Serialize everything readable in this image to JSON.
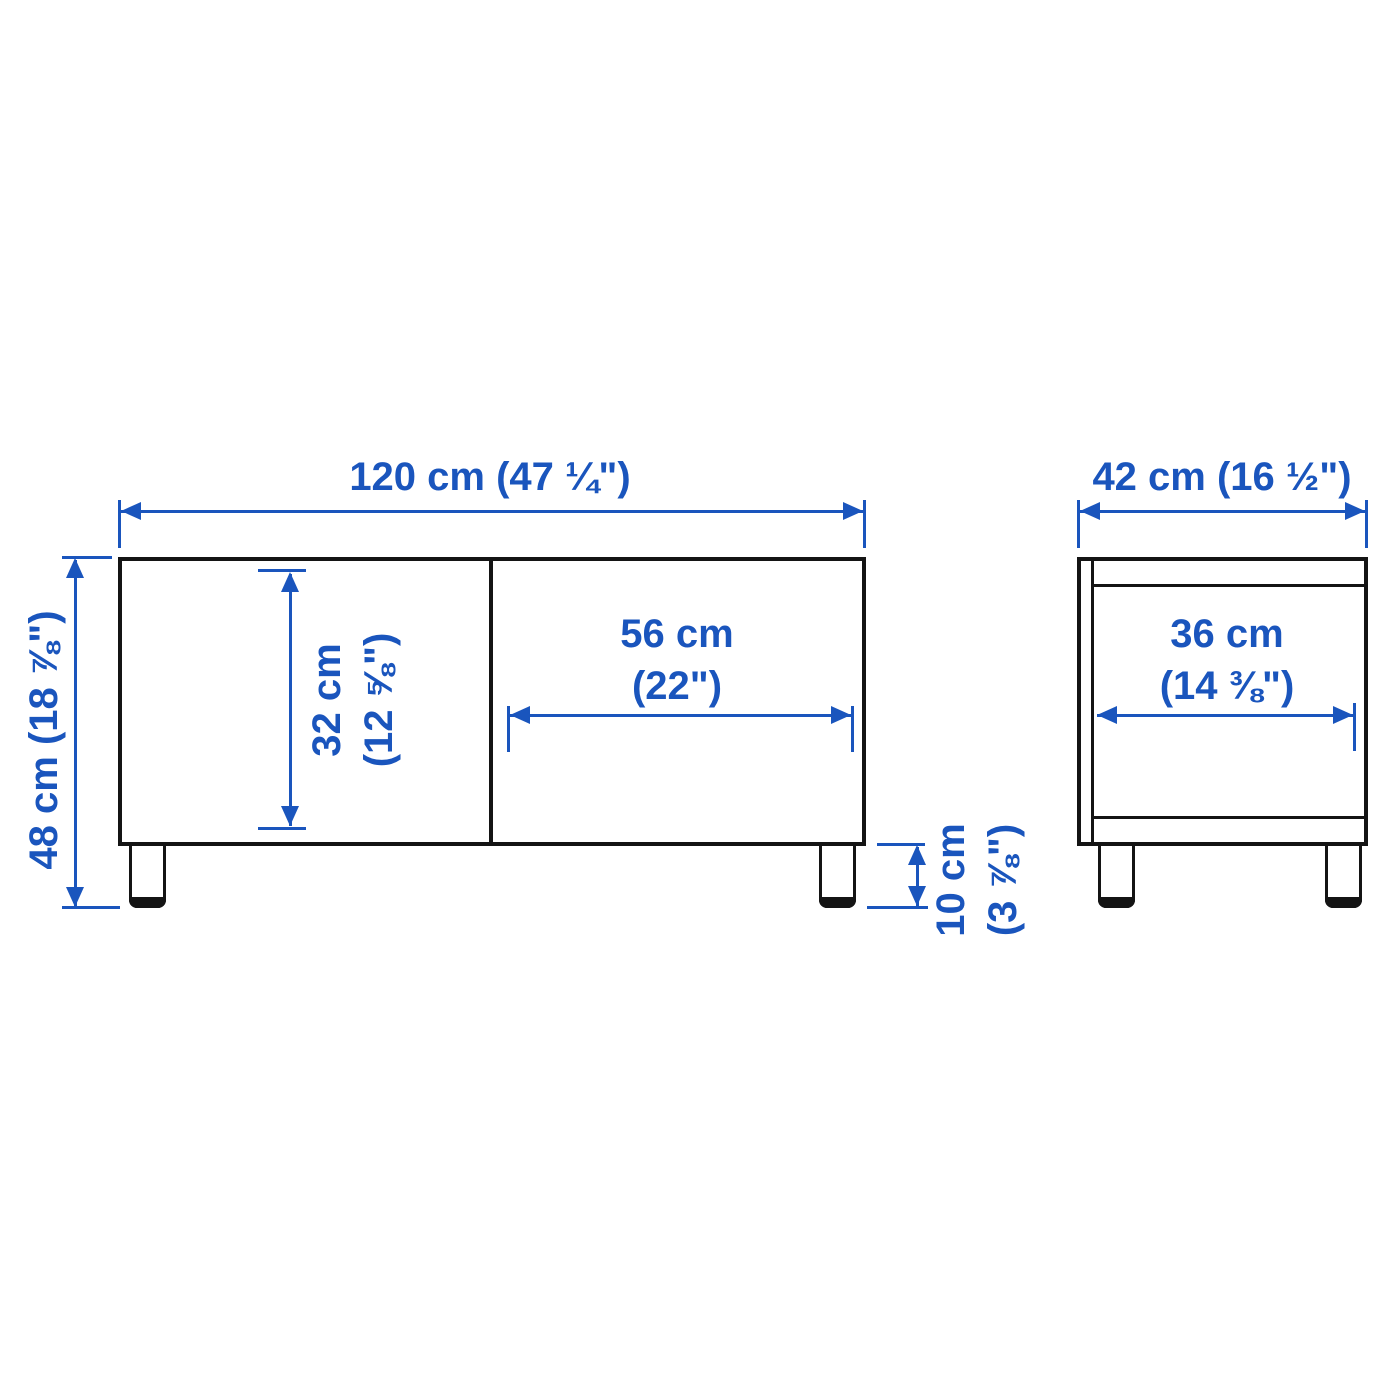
{
  "diagram": {
    "type": "furniture dimension drawing",
    "colors": {
      "dimension_blue": "#1a55bd",
      "outline_black": "#141414",
      "background": "#ffffff"
    },
    "views": {
      "front": {
        "name": "front view",
        "overall_width": "120 cm (47 ¼\")",
        "overall_height": "48 cm (18 ⅞\")",
        "door_height": [
          "32 cm",
          "(12 ⅝\")"
        ],
        "door_width": [
          "56 cm",
          "(22\")"
        ],
        "leg_height": [
          "10 cm",
          "(3 ⅞\")"
        ]
      },
      "side": {
        "name": "side view",
        "depth": "42 cm (16 ½\")",
        "inner_depth": [
          "36 cm",
          "(14 ⅜\")"
        ]
      }
    }
  }
}
